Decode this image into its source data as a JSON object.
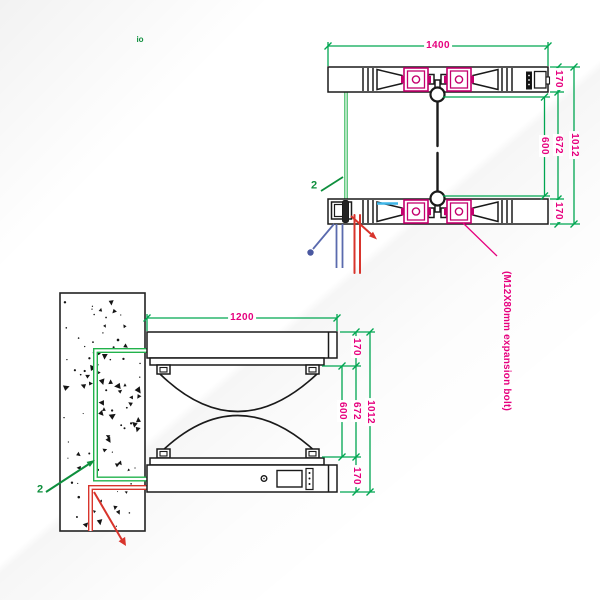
{
  "drawing_title": "flap-barrier installation drawing (top view and front view)",
  "colors": {
    "dimension_line": "#00a651",
    "dimension_text": "#e6007e",
    "mechanism_magenta": "#c4006e",
    "cable_red": "#d8342c",
    "cable_blue": "#5a6aae",
    "cable_green": "#21b24b",
    "highlight_cyan": "#3fb6e8",
    "linework": "#1a1a1a"
  },
  "top_view": {
    "width_label": "1400",
    "top_offset_label": "170",
    "lane_label": "600",
    "inner_label": "672",
    "total_label": "1012",
    "bottom_offset_label": "170",
    "green_callout": "2"
  },
  "front_view": {
    "width_label": "1200",
    "top_offset_label": "170",
    "lane_label": "600",
    "inner_label": "672",
    "total_label": "1012",
    "bottom_offset_label": "170",
    "green_callout": "2"
  },
  "annotations": {
    "bolt_note": "(M12X80mm expansion bolt)",
    "corner_marker": "io"
  }
}
